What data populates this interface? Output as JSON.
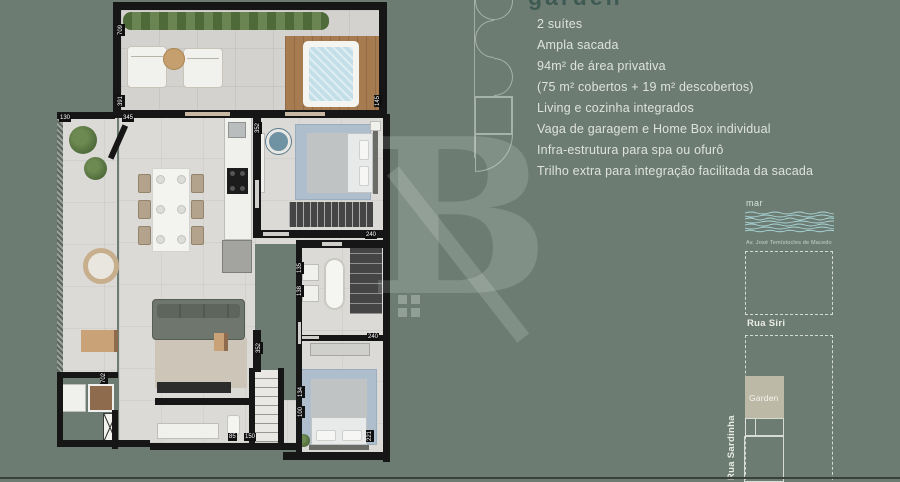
{
  "colors": {
    "background": "#6d7c73",
    "title": "#3f5a53",
    "body_text": "#dde3dc",
    "map_lines": "#e3e8e1",
    "garden_block_fill": "#bcb9a7",
    "water_lines": "#a9d6d8",
    "plan_wall": "#161616",
    "plan_floor": "#dbdad6",
    "deck_wood": "#a67b4f"
  },
  "title": "garden",
  "features": [
    "2 suítes",
    "Ampla sacada",
    "94m² de área privativa",
    "(75 m² cobertos + 19 m² descobertos)",
    "Living e cozinha integrados",
    "Vaga de garagem e Home Box individual",
    "Infra-estrutura para spa ou ofurô",
    "Trilho extra para integração facilitada da sacada"
  ],
  "watermark": {
    "letter": "B"
  },
  "floorplan": {
    "dims": {
      "terrace_height": "709",
      "terrace_left": "391",
      "terrace_right": "145",
      "balcony_width": "130",
      "living_width": "345",
      "suite1_width": "352",
      "suite1_depth": "240",
      "bath2_a": "135",
      "bath2_b": "138",
      "suite2_width": "240",
      "suite2_depth": "221",
      "entry_height": "702",
      "hall_height": "352",
      "hall_a": "134",
      "hall_b": "100",
      "bath1_a": "85",
      "bath1_b": "150"
    }
  },
  "map": {
    "sea_label": "mar",
    "avenue_label": "Av. José Temístocles de Macedo",
    "street_siri": "Rua Siri",
    "street_sardinha": "Rua Sardinha",
    "building_label": "Garden"
  }
}
